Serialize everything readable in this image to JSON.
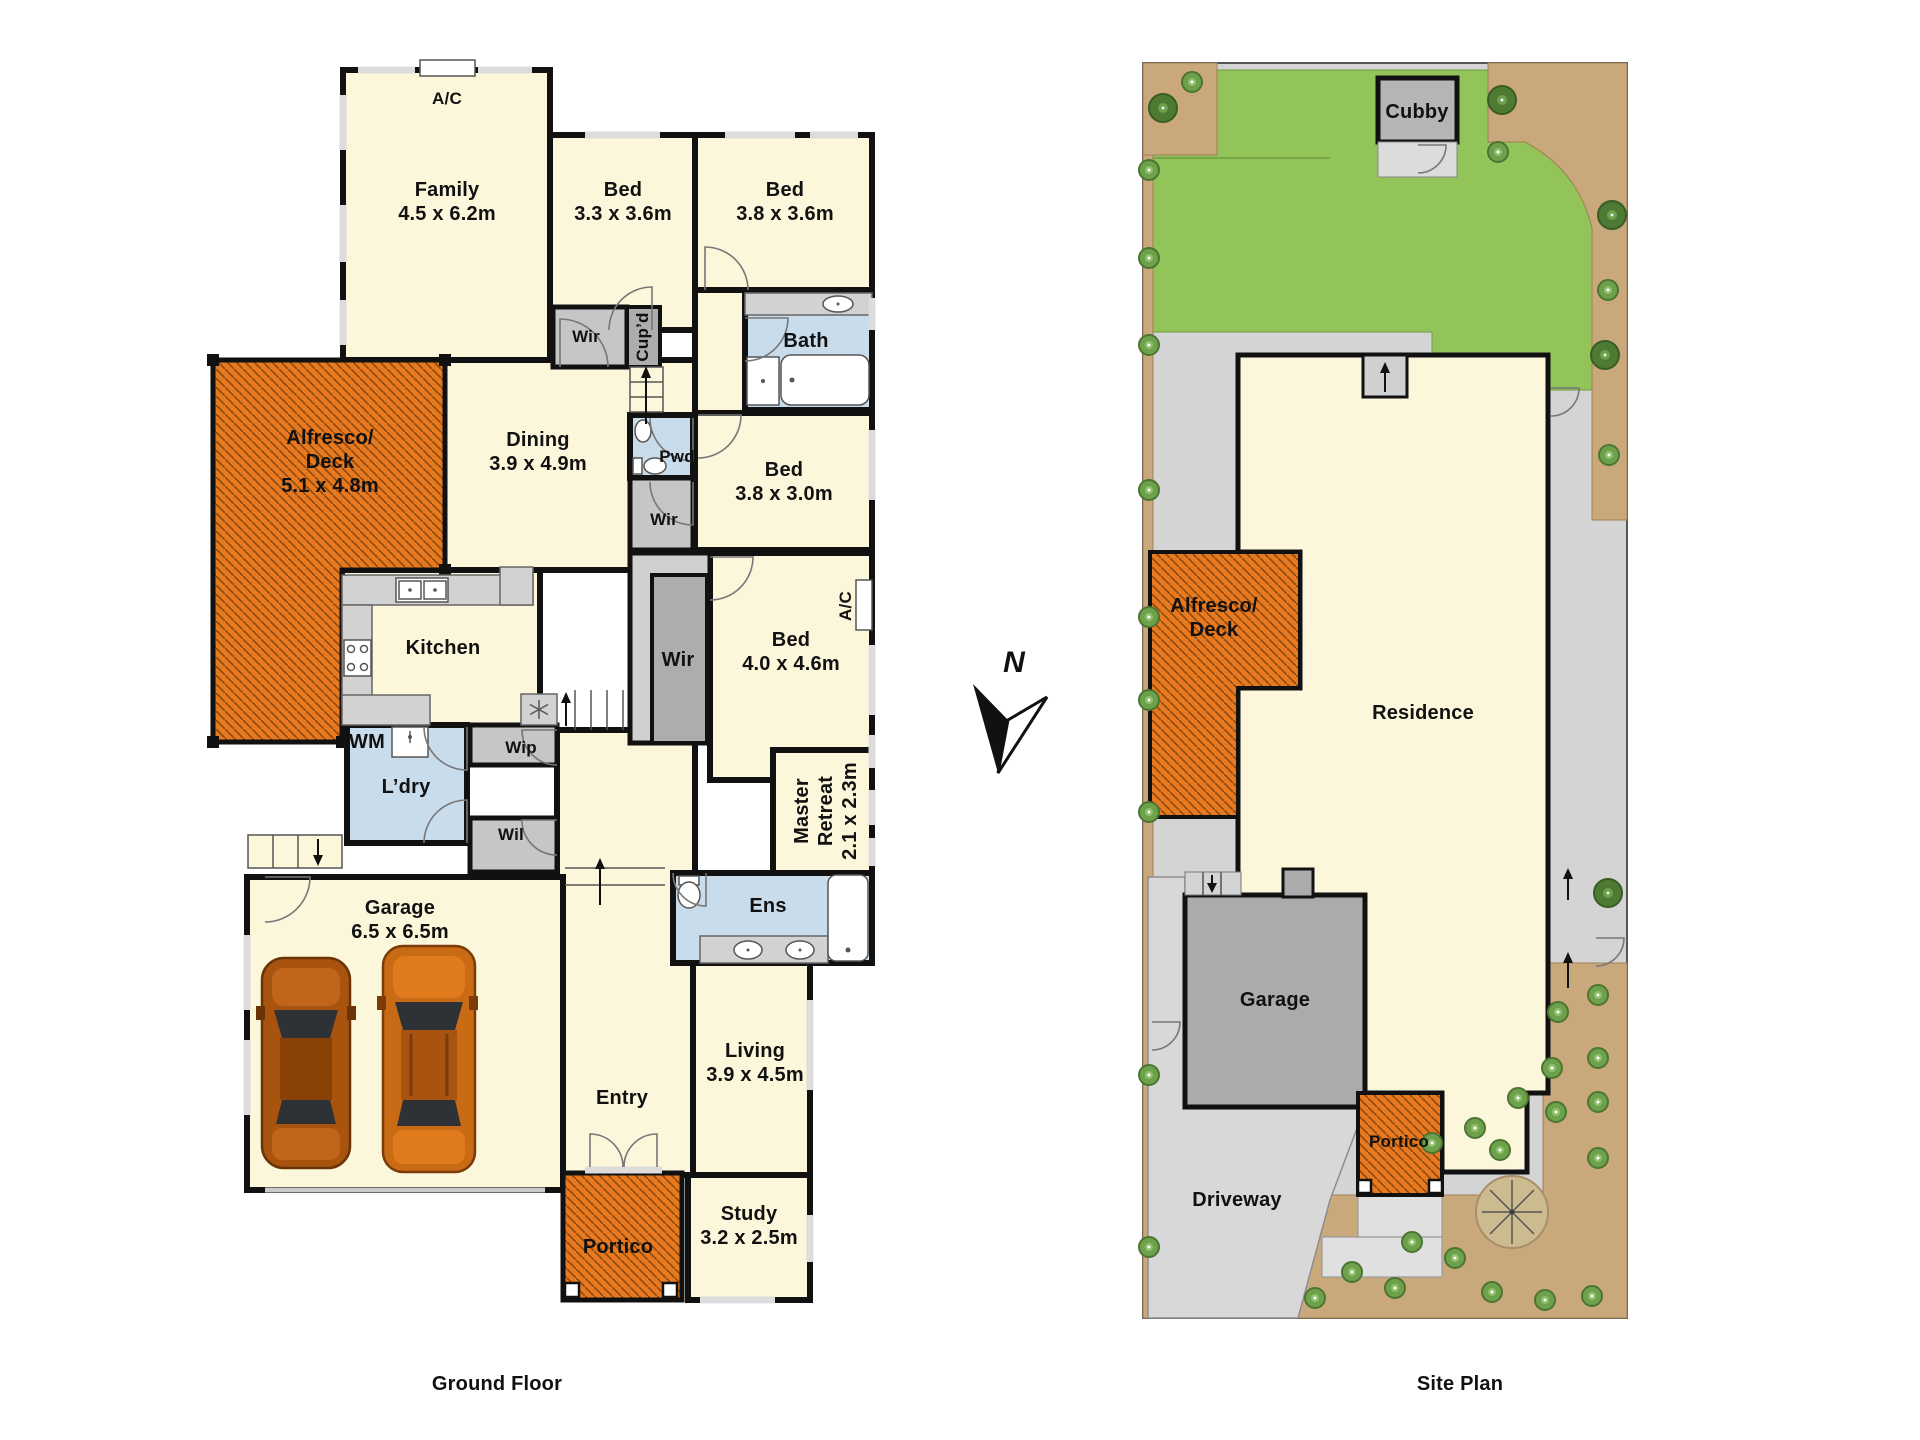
{
  "captions": {
    "ground_floor": "Ground Floor",
    "site_plan": "Site Plan"
  },
  "compass": {
    "label": "N"
  },
  "gf": {
    "ac_family": {
      "name": "A/C"
    },
    "family": {
      "name": "Family",
      "dims": "4.5 x 6.2m"
    },
    "bed1": {
      "name": "Bed",
      "dims": "3.3 x 3.6m"
    },
    "bed2": {
      "name": "Bed",
      "dims": "3.8 x 3.6m"
    },
    "bath": {
      "name": "Bath"
    },
    "wir_small": {
      "name": "Wir"
    },
    "cupd": {
      "name": "Cup’d"
    },
    "alfresco": {
      "name": "Alfresco/",
      "name2": "Deck",
      "dims": "5.1 x 4.8m"
    },
    "dining": {
      "name": "Dining",
      "dims": "3.9 x 4.9m"
    },
    "pwd": {
      "name": "Pwd"
    },
    "wir_mid": {
      "name": "Wir"
    },
    "bed3": {
      "name": "Bed",
      "dims": "3.8 x 3.0m"
    },
    "kitchen": {
      "name": "Kitchen"
    },
    "wir_master": {
      "name": "Wir"
    },
    "bed4": {
      "name": "Bed",
      "dims": "4.0 x 4.6m"
    },
    "ac_bed4": {
      "name": "A/C"
    },
    "wm": {
      "name": "WM"
    },
    "wip": {
      "name": "Wip"
    },
    "ldry": {
      "name": "L’dry"
    },
    "wil": {
      "name": "Wil"
    },
    "master_retreat": {
      "name": "Master",
      "name2": "Retreat",
      "dims": "2.1 x 2.3m"
    },
    "garage": {
      "name": "Garage",
      "dims": "6.5 x 6.5m"
    },
    "ens": {
      "name": "Ens"
    },
    "entry": {
      "name": "Entry"
    },
    "living": {
      "name": "Living",
      "dims": "3.9 x 4.5m"
    },
    "study": {
      "name": "Study",
      "dims": "3.2 x 2.5m"
    },
    "portico": {
      "name": "Portico"
    }
  },
  "site": {
    "cubby": {
      "name": "Cubby"
    },
    "alfresco": {
      "name": "Alfresco/",
      "name2": "Deck"
    },
    "residence": {
      "name": "Residence"
    },
    "garage": {
      "name": "Garage"
    },
    "portico": {
      "name": "Portico"
    },
    "driveway": {
      "name": "Driveway"
    }
  },
  "colors": {
    "deck_orange": "#e8791f",
    "hatch_line": "#8a4a10",
    "room_cream": "#fcf6da",
    "wet_blue": "#c9dcec",
    "lawn_green": "#92c45a",
    "garden_sand": "#c9a87c",
    "path_gray": "#d4d4d4",
    "wall_black": "#111111"
  }
}
